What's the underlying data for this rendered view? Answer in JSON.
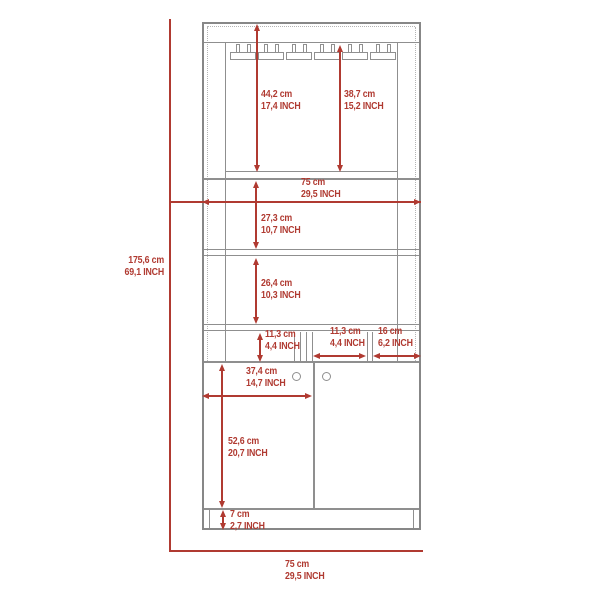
{
  "diagram": {
    "type": "furniture-dimension-drawing",
    "subject": "bar-cabinet-with-glass-rack-front-elevation",
    "accent_color": "#b03a31",
    "outline_color": "#8f8f8f",
    "units": [
      "cm",
      "INCH"
    ],
    "dims": {
      "overall_height": {
        "cm": "175,6 cm",
        "inch": "69,1 INCH"
      },
      "top_section": {
        "cm": "44,2 cm",
        "inch": "17,4 INCH"
      },
      "rack_clearance": {
        "cm": "38,7 cm",
        "inch": "15,2 INCH"
      },
      "inner_width": {
        "cm": "75 cm",
        "inch": "29,5 INCH"
      },
      "upper_shelf": {
        "cm": "27,3 cm",
        "inch": "10,7 INCH"
      },
      "lower_shelf": {
        "cm": "26,4 cm",
        "inch": "10,3 INCH"
      },
      "cubby_height": {
        "cm": "11,3 cm",
        "inch": "4,4 INCH"
      },
      "cubby_width": {
        "cm": "11,3 cm",
        "inch": "4,4 INCH"
      },
      "side_cubby_width": {
        "cm": "16 cm",
        "inch": "6,2 INCH"
      },
      "door_width": {
        "cm": "37,4 cm",
        "inch": "14,7 INCH"
      },
      "door_height": {
        "cm": "52,6 cm",
        "inch": "20,7 INCH"
      },
      "base_height": {
        "cm": "7 cm",
        "inch": "2,7 INCH"
      },
      "overall_width": {
        "cm": "75 cm",
        "inch": "29,5 INCH"
      }
    }
  }
}
